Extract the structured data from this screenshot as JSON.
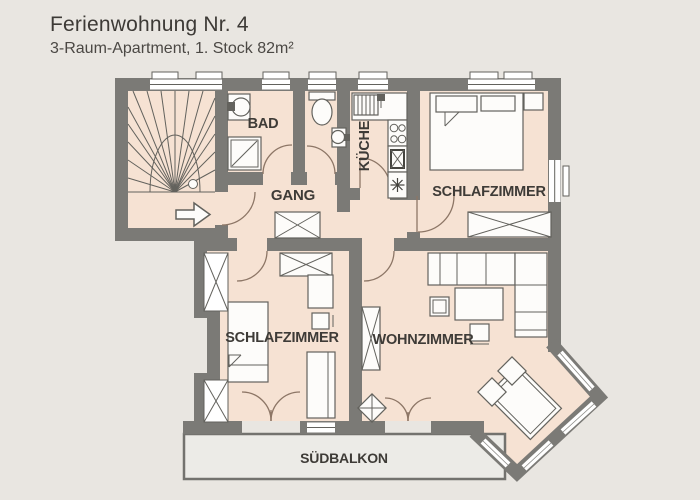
{
  "header": {
    "title": "Ferienwohnung Nr. 4",
    "subtitle": "3-Raum-Apartment, 1. Stock 82m²"
  },
  "rooms": {
    "bad": {
      "label": "BAD"
    },
    "gang": {
      "label": "GANG"
    },
    "kueche": {
      "label": "KÜCHE"
    },
    "schlafzimmer_top": {
      "label": "SCHLAFZIMMER"
    },
    "schlafzimmer_bottom": {
      "label": "SCHLAFZIMMER"
    },
    "wohnzimmer": {
      "label": "WOHNZIMMER"
    },
    "suedbalkon": {
      "label": "SÜDBALKON"
    }
  },
  "colors": {
    "background": "#e9e6e1",
    "room_fill": "#f6e2d3",
    "wall": "#7b7a76",
    "furniture_fill": "#fdfcfa",
    "door_arc": "#8d7666",
    "text": "#3e3b37"
  }
}
